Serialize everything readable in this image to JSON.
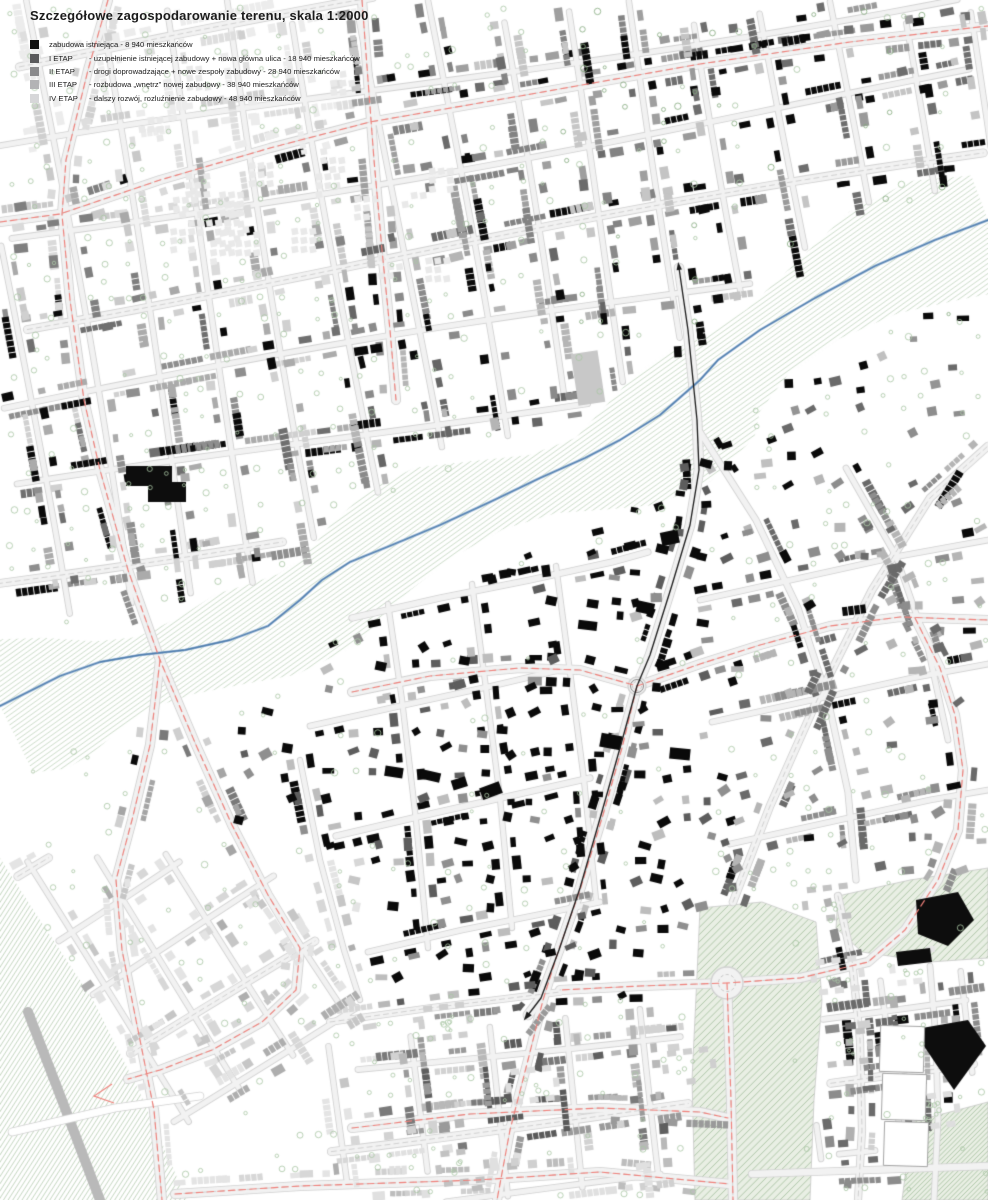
{
  "title": "Szczegółowe zagospodarowanie terenu, skala 1:2000",
  "legend": {
    "items": [
      {
        "swatch": "#101010",
        "label": "zabudowa istniejąca - 8 940 mieszkańców",
        "desc": ""
      },
      {
        "swatch": "#59595b",
        "label": "I ETAP",
        "desc": "- uzupełnienie istniejącej zabudowy + nowa główna ulica - 18 940 mieszkańców"
      },
      {
        "swatch": "#8a8a8c",
        "label": "II ETAP",
        "desc": "- drogi doprowadzające + nowe zespoły zabudowy - 28 940 mieszkańców"
      },
      {
        "swatch": "#b3b3b5",
        "label": "III ETAP",
        "desc": "- rozbudowa „wnętrz” nowej zabudowy - 38 940 mieszkańców"
      },
      {
        "swatch": "#d7d7d9",
        "label": "IV ETAP",
        "desc": "- dalszy rozwój, rozluźnienie zabudowy - 48 940 mieszkańców"
      }
    ]
  },
  "map": {
    "colors": {
      "red": "#f0807a",
      "river": "#4d7cae",
      "river_halo": "#9db8d4",
      "hatch": "#9cba96",
      "park_fill": "#e9efe4",
      "street_fill": "#f2f2f2",
      "street_casing": "#d2d2d2",
      "centerline": "#c6c6c6",
      "tree": "#a9c6a4",
      "tree_dark": "#84aa7e",
      "gray_road": "#b9b9b9",
      "axis": "#1b1b1b"
    },
    "river": [
      [
        988,
        220
      ],
      [
        935,
        240
      ],
      [
        875,
        266
      ],
      [
        815,
        298
      ],
      [
        760,
        330
      ],
      [
        718,
        360
      ],
      [
        700,
        380
      ],
      [
        660,
        415
      ],
      [
        620,
        440
      ],
      [
        585,
        458
      ],
      [
        540,
        478
      ],
      [
        490,
        502
      ],
      [
        440,
        525
      ],
      [
        392,
        545
      ],
      [
        350,
        562
      ],
      [
        322,
        580
      ],
      [
        300,
        600
      ],
      [
        268,
        626
      ],
      [
        230,
        640
      ],
      [
        185,
        650
      ],
      [
        140,
        655
      ],
      [
        100,
        662
      ],
      [
        60,
        676
      ],
      [
        28,
        692
      ],
      [
        0,
        706
      ]
    ],
    "axis": [
      [
        679,
        268
      ],
      [
        688,
        330
      ],
      [
        697,
        420
      ],
      [
        699,
        470
      ],
      [
        690,
        525
      ],
      [
        672,
        585
      ],
      [
        650,
        655
      ],
      [
        637,
        686
      ],
      [
        620,
        748
      ],
      [
        601,
        815
      ],
      [
        580,
        888
      ],
      [
        559,
        950
      ],
      [
        541,
        998
      ],
      [
        528,
        1015
      ]
    ],
    "red_roads": [
      {
        "pts": [
          [
            0,
            222
          ],
          [
            60,
            214
          ],
          [
            160,
            180
          ],
          [
            270,
            148
          ],
          [
            370,
            122
          ],
          [
            520,
            96
          ],
          [
            700,
            64
          ],
          [
            850,
            42
          ],
          [
            988,
            26
          ]
        ]
      },
      {
        "pts": [
          [
            108,
            0
          ],
          [
            88,
            70
          ],
          [
            66,
            160
          ],
          [
            62,
            215
          ],
          [
            70,
            300
          ],
          [
            84,
            400
          ],
          [
            100,
            470
          ],
          [
            128,
            570
          ],
          [
            160,
            660
          ],
          [
            196,
            745
          ],
          [
            232,
            825
          ],
          [
            268,
            895
          ],
          [
            300,
            948
          ],
          [
            296,
            990
          ],
          [
            262,
            1022
          ],
          [
            212,
            1050
          ],
          [
            160,
            1070
          ],
          [
            128,
            1079
          ]
        ],
        "arrow": [
          [
            112,
            1084
          ],
          [
            94,
            1096
          ],
          [
            114,
            1103
          ]
        ]
      },
      {
        "pts": [
          [
            362,
            0
          ],
          [
            368,
            80
          ],
          [
            374,
            160
          ],
          [
            382,
            250
          ],
          [
            390,
            330
          ],
          [
            396,
            400
          ]
        ]
      },
      {
        "pts": [
          [
            352,
            692
          ],
          [
            430,
            676
          ],
          [
            520,
            668
          ],
          [
            580,
            670
          ],
          [
            637,
            686
          ],
          [
            700,
            664
          ],
          [
            760,
            645
          ],
          [
            830,
            626
          ],
          [
            900,
            617
          ],
          [
            988,
            620
          ]
        ]
      },
      {
        "pts": [
          [
            637,
            686
          ],
          [
            622,
            748
          ],
          [
            603,
            815
          ],
          [
            580,
            890
          ],
          [
            558,
            952
          ],
          [
            543,
            1000
          ],
          [
            528,
            1060
          ],
          [
            510,
            1130
          ],
          [
            497,
            1200
          ]
        ]
      },
      {
        "pts": [
          [
            160,
            660
          ],
          [
            150,
            745
          ],
          [
            132,
            820
          ],
          [
            116,
            880
          ],
          [
            122,
            950
          ],
          [
            138,
            1030
          ],
          [
            154,
            1110
          ],
          [
            162,
            1200
          ]
        ]
      },
      {
        "pts": [
          [
            727,
            983
          ],
          [
            729,
            1040
          ],
          [
            731,
            1100
          ],
          [
            733,
            1200
          ]
        ]
      },
      {
        "pts": [
          [
            915,
            618
          ],
          [
            940,
            668
          ],
          [
            955,
            715
          ],
          [
            963,
            770
          ],
          [
            958,
            830
          ],
          [
            938,
            880
          ],
          [
            905,
            930
          ],
          [
            868,
            962
          ],
          [
            800,
            978
          ],
          [
            727,
            983
          ],
          [
            640,
            986
          ],
          [
            560,
            990
          ]
        ]
      },
      {
        "pts": [
          [
            175,
            1194
          ],
          [
            300,
            1186
          ],
          [
            478,
            1180
          ],
          [
            600,
            1172
          ],
          [
            730,
            1184
          ]
        ]
      },
      {
        "pts": [
          [
            352,
            1128
          ],
          [
            470,
            1114
          ],
          [
            600,
            1108
          ],
          [
            700,
            1112
          ],
          [
            728,
            1118
          ]
        ]
      }
    ],
    "roads_extra": [
      {
        "pts": [
          [
            352,
            618
          ],
          [
            440,
            598
          ],
          [
            530,
            580
          ],
          [
            612,
            562
          ],
          [
            648,
            552
          ]
        ],
        "w": 5.5
      },
      {
        "pts": [
          [
            310,
            726
          ],
          [
            400,
            706
          ],
          [
            492,
            686
          ],
          [
            568,
            668
          ]
        ],
        "w": 5
      },
      {
        "pts": [
          [
            336,
            836
          ],
          [
            430,
            814
          ],
          [
            528,
            792
          ],
          [
            590,
            778
          ]
        ],
        "w": 5.5
      },
      {
        "pts": [
          [
            368,
            952
          ],
          [
            462,
            930
          ],
          [
            552,
            912
          ],
          [
            600,
            902
          ]
        ],
        "w": 5
      },
      {
        "pts": [
          [
            388,
            604
          ],
          [
            402,
            700
          ],
          [
            416,
            820
          ],
          [
            428,
            948
          ]
        ],
        "w": 4.6
      },
      {
        "pts": [
          [
            472,
            584
          ],
          [
            486,
            688
          ],
          [
            500,
            798
          ],
          [
            512,
            928
          ]
        ],
        "w": 4.6
      },
      {
        "pts": [
          [
            556,
            566
          ],
          [
            570,
            672
          ],
          [
            584,
            780
          ],
          [
            596,
            900
          ]
        ],
        "w": 4.6
      },
      {
        "pts": [
          [
            300,
            760
          ],
          [
            320,
            860
          ],
          [
            344,
            950
          ],
          [
            360,
            1000
          ]
        ],
        "w": 4.6
      },
      {
        "pts": [
          [
            700,
            432
          ],
          [
            756,
            520
          ],
          [
            798,
            608
          ],
          [
            828,
            700
          ],
          [
            848,
            792
          ],
          [
            856,
            880
          ]
        ],
        "w": 5.5
      },
      {
        "pts": [
          [
            846,
            468
          ],
          [
            896,
            556
          ],
          [
            928,
            648
          ],
          [
            948,
            740
          ]
        ],
        "w": 5
      },
      {
        "pts": [
          [
            700,
            600
          ],
          [
            800,
            578
          ],
          [
            900,
            556
          ],
          [
            988,
            540
          ]
        ],
        "w": 5
      },
      {
        "pts": [
          [
            712,
            722
          ],
          [
            812,
            700
          ],
          [
            912,
            678
          ],
          [
            988,
            664
          ]
        ],
        "w": 5
      },
      {
        "pts": [
          [
            730,
            844
          ],
          [
            830,
            822
          ],
          [
            930,
            800
          ],
          [
            988,
            790
          ]
        ],
        "w": 5
      },
      {
        "pts": [
          [
            330,
            1022
          ],
          [
            430,
            1008
          ],
          [
            560,
            992
          ]
        ],
        "w": 6,
        "dash": true
      },
      {
        "pts": [
          [
            733,
            902
          ],
          [
            770,
            806
          ],
          [
            818,
            698
          ],
          [
            872,
            590
          ],
          [
            930,
            498
          ],
          [
            988,
            446
          ]
        ],
        "w": 7,
        "dash": true
      },
      {
        "pts": [
          [
            838,
            896
          ],
          [
            852,
            960
          ],
          [
            860,
            1040
          ],
          [
            862,
            1130
          ],
          [
            858,
            1200
          ]
        ],
        "w": 6.5,
        "dash": true
      },
      {
        "pts": [
          [
            752,
            1174
          ],
          [
            870,
            1170
          ],
          [
            988,
            1166
          ]
        ],
        "w": 6.5
      },
      {
        "pts": [
          [
            930,
            966
          ],
          [
            936,
            1040
          ],
          [
            938,
            1120
          ],
          [
            934,
            1200
          ]
        ],
        "w": 5
      },
      {
        "pts": [
          [
            28,
            1012
          ],
          [
            60,
            1095
          ],
          [
            100,
            1200
          ]
        ],
        "w": 10,
        "skin": "gray"
      },
      {
        "pts": [
          [
            12,
            1132
          ],
          [
            115,
            1108
          ],
          [
            200,
            1096
          ]
        ],
        "w": 7,
        "skin": "white"
      }
    ],
    "parks": [
      [
        [
          700,
          908
        ],
        [
          762,
          902
        ],
        [
          816,
          922
        ],
        [
          822,
          1000
        ],
        [
          814,
          1100
        ],
        [
          810,
          1200
        ],
        [
          695,
          1200
        ],
        [
          692,
          1080
        ],
        [
          697,
          975
        ]
      ],
      [
        [
          838,
          896
        ],
        [
          910,
          880
        ],
        [
          988,
          868
        ],
        [
          988,
          958
        ],
        [
          930,
          962
        ],
        [
          862,
          952
        ],
        [
          836,
          928
        ]
      ],
      [
        [
          912,
          1122
        ],
        [
          988,
          1102
        ],
        [
          988,
          1200
        ],
        [
          902,
          1200
        ]
      ]
    ],
    "bl_hatch": [
      [
        0,
        858
      ],
      [
        30,
        905
      ],
      [
        93,
        1000
      ],
      [
        140,
        1093
      ],
      [
        187,
        1200
      ],
      [
        0,
        1200
      ]
    ],
    "roundabouts": [
      {
        "x": 727,
        "y": 983,
        "r": 16,
        "ri": 8.5
      },
      {
        "x": 637,
        "y": 686,
        "r": 9,
        "ri": 4.5
      }
    ],
    "special": {
      "gray_rect": {
        "cx": 588,
        "cy": 378,
        "w": 27,
        "h": 52,
        "rot": -0.15
      },
      "black_polys": [
        [
          [
            126,
            466
          ],
          [
            172,
            466
          ],
          [
            172,
            482
          ],
          [
            186,
            482
          ],
          [
            186,
            502
          ],
          [
            148,
            502
          ],
          [
            148,
            486
          ],
          [
            126,
            486
          ]
        ],
        [
          [
            916,
            900
          ],
          [
            958,
            892
          ],
          [
            974,
            920
          ],
          [
            948,
            946
          ],
          [
            918,
            934
          ]
        ],
        [
          [
            922,
            1028
          ],
          [
            968,
            1020
          ],
          [
            986,
            1046
          ],
          [
            954,
            1090
          ],
          [
            936,
            1064
          ],
          [
            924,
            1046
          ]
        ],
        [
          [
            896,
            952
          ],
          [
            930,
            948
          ],
          [
            932,
            962
          ],
          [
            898,
            966
          ]
        ]
      ],
      "slabs": [
        {
          "x": 880,
          "y": 1026,
          "w": 44,
          "h": 46
        },
        {
          "x": 882,
          "y": 1074,
          "w": 44,
          "h": 46
        },
        {
          "x": 884,
          "y": 1122,
          "w": 44,
          "h": 44
        }
      ]
    }
  }
}
